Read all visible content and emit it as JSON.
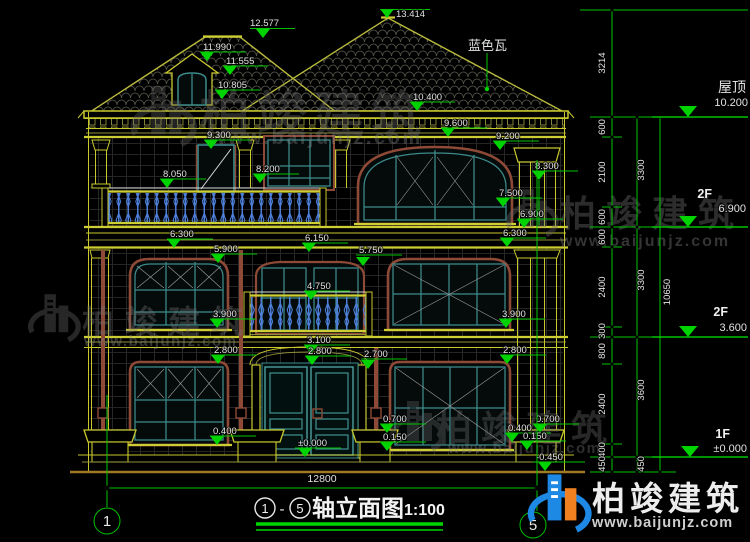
{
  "drawing": {
    "title_axis_start": "1",
    "title_axis_end": "5",
    "title_dash": "-",
    "title_text": "轴立面图",
    "title_scale": "1:100",
    "roof_note": "蓝色瓦",
    "total_width_dim": "12800",
    "axis_left": "1",
    "axis_right": "5"
  },
  "marks": {
    "ridge_left": "12.577",
    "ridge_main": "13.414",
    "dormer_peak": "11.990",
    "dormer_eave": "11.555",
    "dormer_sill": "10.805",
    "eave_right": "10.400",
    "f3_door_top": "9.300",
    "f3_cornice": "9.600",
    "f3_win_arch": "9.200",
    "f3_col_cap": "8.300",
    "f3_rail_left": "8.050",
    "f3_rail_mid": "8.200",
    "f3_win_transom": "7.500",
    "f3_win_sill": "6.900",
    "f2_band_left": "6.300",
    "f2_band_right": "6.300",
    "f2_win_arch_left": "5.900",
    "f2_band_mid": "6.150",
    "f2_door_arch": "5.750",
    "f2_rail_top": "4.750",
    "f2_win_sill_left": "3.900",
    "f2_win_sill_right": "3.900",
    "f1_arch_apex": "3.100",
    "f1_door_top": "2.800",
    "f1_win_arch_left": "2.800",
    "f1_win_arch_right": "2.800",
    "f1_win_top_right": "2.700",
    "f1_sill_left": "0.400",
    "f1_sill_mid_top": "0.700",
    "f1_sill_mid_bot": "0.150",
    "f1_floor": "±0.000",
    "base_top_right": "0.700",
    "base_mid_right": "0.400",
    "base_low_right": "0.150",
    "ground_right": "-0.450"
  },
  "dims": {
    "chain_a": [
      "3214",
      "600",
      "2100",
      "600",
      "600",
      "2400",
      "300",
      "800",
      "2400",
      "400",
      "450"
    ],
    "chain_b": [
      "3300",
      "3300",
      "3600",
      "450"
    ],
    "chain_c": [
      "10650"
    ]
  },
  "levels": [
    {
      "name": "屋顶",
      "value": "10.200"
    },
    {
      "name": "2F",
      "value": "6.900"
    },
    {
      "name": "2F",
      "value": "3.600"
    },
    {
      "name": "1F",
      "value": "±0.000"
    }
  ],
  "watermark": {
    "brand": "柏竣建筑",
    "url": "www.baijunjz.com"
  },
  "colors": {
    "background": "#000000",
    "cad_yellow": "#c9c92e",
    "dim_green": "#00c400",
    "frame_teal": "#3d8c8c",
    "frame_brown": "#8e4a36",
    "baluster_blue": "#4d7ed8",
    "text_white": "#e2e2e2",
    "logo_blue": "#1e88e5",
    "logo_orange": "#f08020"
  }
}
